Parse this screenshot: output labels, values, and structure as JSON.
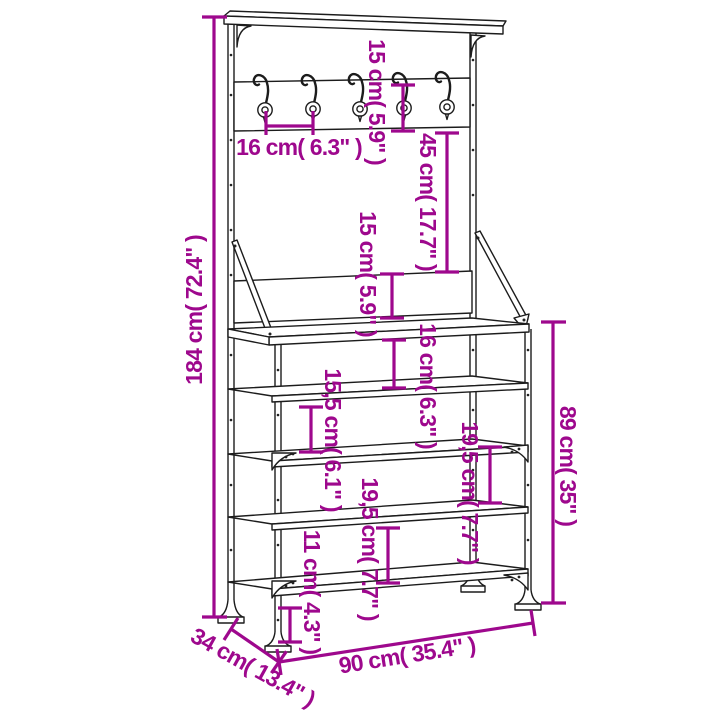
{
  "diagram": {
    "kind": "furniture-dimension-diagram",
    "product": "clothes-rack-with-shoe-storage",
    "hook_count": 5,
    "shelf_count": 5,
    "colors": {
      "background": "#ffffff",
      "line_art": "#1c1c1c",
      "dimension": "#9E088D"
    }
  },
  "dimensions": {
    "total_height": {
      "label": "184 cm( 72.4\" )",
      "cm": "184",
      "inch": "72.4"
    },
    "rail_board_height": {
      "label": "15 cm( 5.9\" )",
      "cm": "15",
      "inch": "5.9"
    },
    "hook_spacing": {
      "label": "16 cm( 6.3\" )",
      "cm": "16",
      "inch": "6.3"
    },
    "rail_to_backboard": {
      "label": "45 cm( 17.7\" )",
      "cm": "45",
      "inch": "17.7"
    },
    "backboard_height": {
      "label": "15 cm( 5.9\" )",
      "cm": "15",
      "inch": "5.9"
    },
    "bench_to_shelf_gap": {
      "label": "16 cm( 6.3\" )",
      "cm": "16",
      "inch": "6.3"
    },
    "shelf_gap_upper": {
      "label": "15,5 cm( 6.1\" )",
      "cm": "15,5",
      "inch": "6.1"
    },
    "shelf_gap_middle": {
      "label": "19,5 cm( 7.7\" )",
      "cm": "19,5",
      "inch": "7.7"
    },
    "shelf_gap_lower": {
      "label": "19,5 cm( 7.7\" )",
      "cm": "19,5",
      "inch": "7.7"
    },
    "floor_clearance": {
      "label": "11 cm( 4.3\" )",
      "cm": "11",
      "inch": "4.3"
    },
    "bench_height": {
      "label": "89 cm( 35\" )",
      "cm": "89",
      "inch": "35"
    },
    "width": {
      "label": "90 cm( 35.4\" )",
      "cm": "90",
      "inch": "35.4"
    },
    "depth": {
      "label": "34 cm( 13.4\" )",
      "cm": "34",
      "inch": "13.4"
    }
  }
}
